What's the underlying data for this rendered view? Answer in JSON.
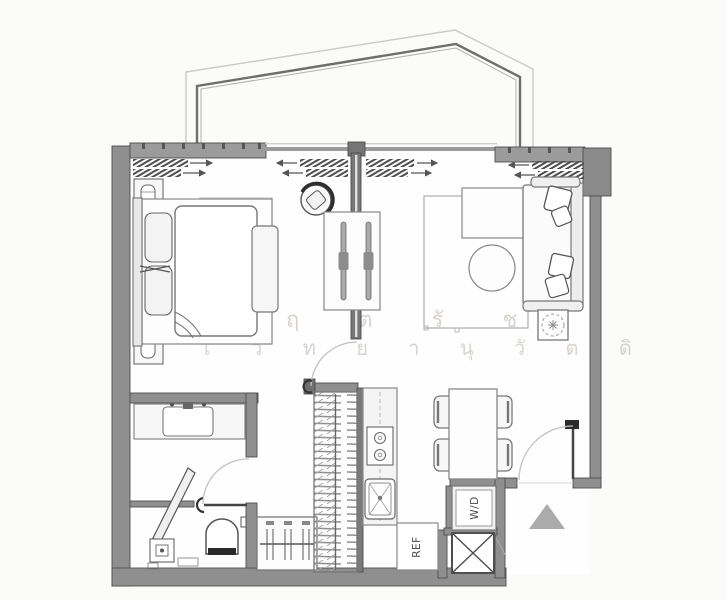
{
  "floorplan": {
    "labels": {
      "washer_dryer": "W/D",
      "refrigerator": "REF"
    },
    "watermark": {
      "line1": "ป ฤ ต  รั  ช",
      "line2": "โ ว ท ย า นุ วั ต ดิ"
    },
    "colors": {
      "background": "#fbfbfa",
      "interior_floor": "#fefefe",
      "wall_fill": "#8f8f8f",
      "wall_outline": "#4e4e4e",
      "furniture_line": "#6a6a6a",
      "door_swing_line": "#c2c2c2",
      "balcony_light_line": "#c9c9c9",
      "balcony_dark_line": "#6e6e6e",
      "entry_marker": "#ababab",
      "door_handle": "#2b2b2b"
    },
    "symbols": {
      "entry_marker": "triangle-up-icon",
      "shaft": "crossed-box",
      "plant": "dashed-circle"
    }
  }
}
